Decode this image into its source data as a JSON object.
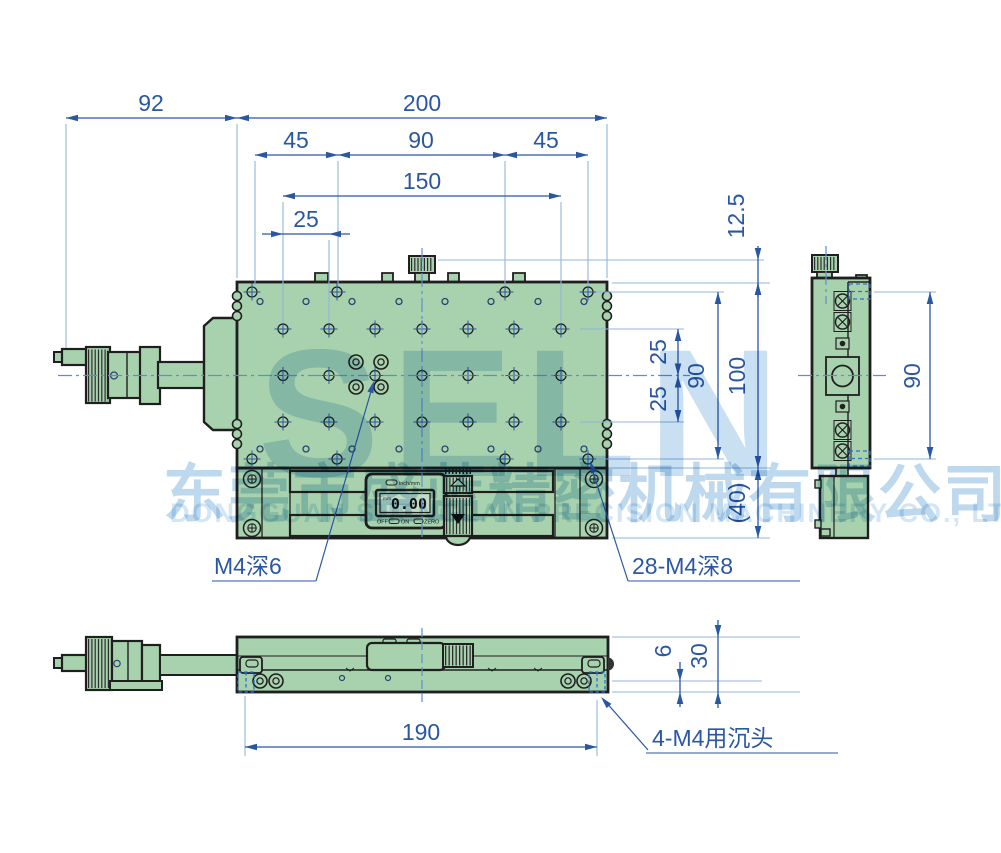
{
  "title": "linear-stage-technical-drawing",
  "dims": {
    "w92": "92",
    "w200": "200",
    "w45l": "45",
    "w90mid": "90",
    "w45r": "45",
    "w150": "150",
    "w25col": "25",
    "h12_5": "12.5",
    "h25a": "25",
    "h25b": "25",
    "h90rows": "90",
    "h100": "100",
    "h40": "(40)",
    "side90": "90",
    "f6": "6",
    "f30": "30",
    "f190": "190"
  },
  "labels": {
    "m4_depth6": "M4深6",
    "m4_grid": "28-M4深8",
    "m4_countersunk": "4-M4用沉头"
  },
  "caliper": {
    "mode": "inch/mm",
    "value": "0.00",
    "unit": "mm",
    "off": "OFF",
    "on": "ON",
    "zero": "ZERO"
  },
  "watermark": {
    "brand": "SELN",
    "company_cn": "东莞市盛蓝精密机械有限公司",
    "company_en": "DONGGUAN SHENGLAN PRECISION MACHINERY CO., LTD."
  },
  "colors": {
    "body_green": "#a8d2ad",
    "outline": "#1f1f1f",
    "dim_blue": "#2a57a3",
    "ext_blue": "#8fb4dc",
    "hidden_blue": "#2e6fd0",
    "center_blue": "#5d8fd0",
    "watermark_blue": "#c9e0f2"
  }
}
